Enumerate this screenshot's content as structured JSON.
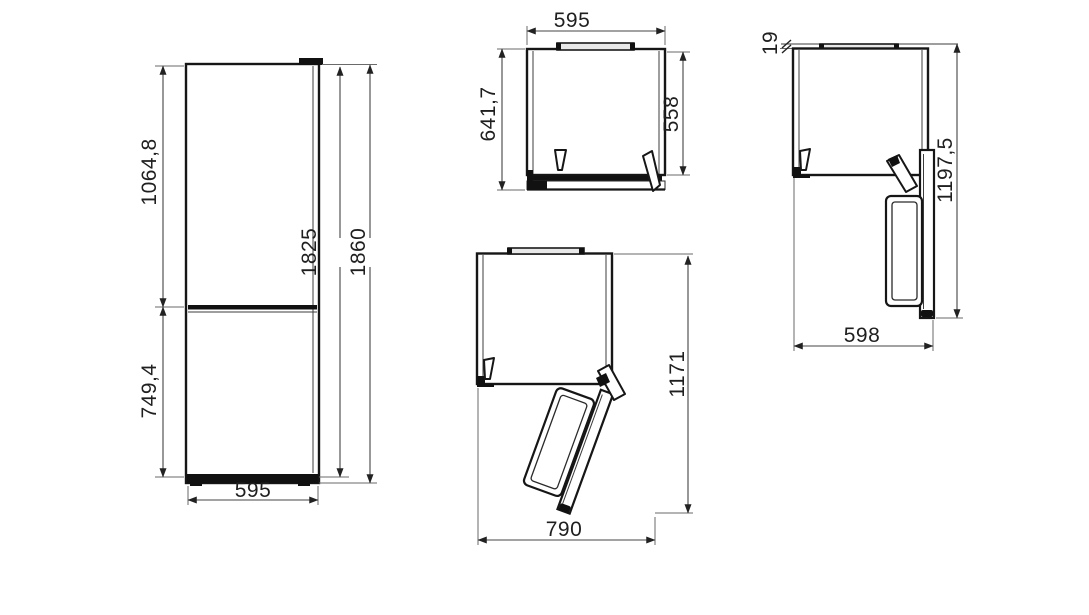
{
  "drawing": {
    "front_view": {
      "upper_compartment_height": "1064,8",
      "lower_compartment_height": "749,4",
      "door_height": "1825",
      "total_height": "1860",
      "width": "595"
    },
    "top_view_closed": {
      "width": "595",
      "depth_with_door": "641,7",
      "depth_body": "558"
    },
    "top_view_door_open_90": {
      "wall_clearance": "19",
      "depth_door_open": "1197,5",
      "width_door_open": "598"
    },
    "top_view_door_open_wide": {
      "depth_door_open": "1171",
      "width_door_open": "790"
    }
  }
}
